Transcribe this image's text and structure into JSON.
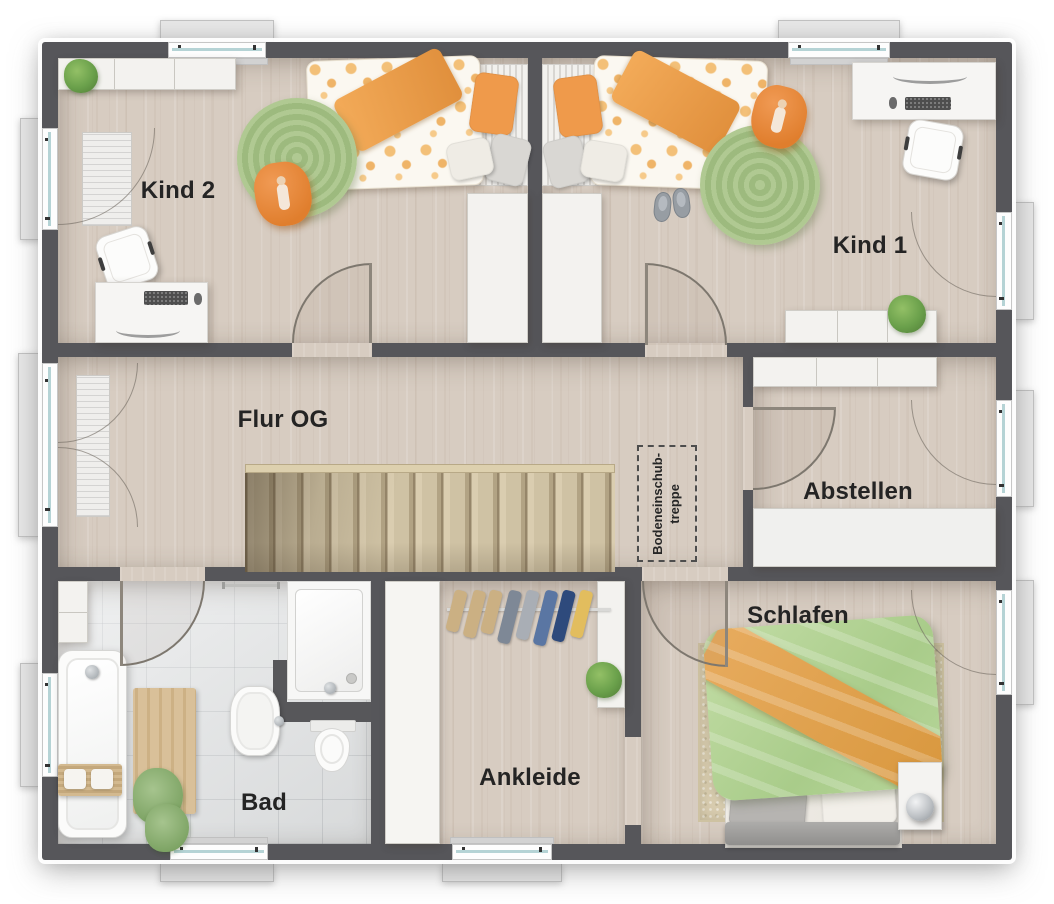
{
  "floorplan": {
    "rooms": [
      {
        "id": "kind2",
        "label": "Kind 2",
        "furniture": [
          "sideboard",
          "plant",
          "single-bed",
          "round-rug",
          "beanbag",
          "desk",
          "desk-chair",
          "wardrobe"
        ]
      },
      {
        "id": "kind1",
        "label": "Kind 1",
        "furniture": [
          "single-bed",
          "slippers",
          "round-rug",
          "beanbag",
          "desk",
          "desk-chair",
          "sideboard",
          "plant",
          "wardrobe"
        ]
      },
      {
        "id": "flur",
        "label": "Flur OG",
        "furniture": [
          "staircase"
        ]
      },
      {
        "id": "abstellen",
        "label": "Abstellen",
        "furniture": [
          "wall-cabinets",
          "shelf"
        ]
      },
      {
        "id": "schlafen",
        "label": "Schlafen",
        "furniture": [
          "double-bed",
          "rug",
          "nightstand",
          "lamp"
        ]
      },
      {
        "id": "ankleide",
        "label": "Ankleide",
        "furniture": [
          "wardrobe",
          "clothes-rail",
          "shelf",
          "plant"
        ]
      },
      {
        "id": "bad",
        "label": "Bad",
        "furniture": [
          "bathtub",
          "bath-mat",
          "towels",
          "sink",
          "toilet",
          "shower",
          "cabinet",
          "towel-bar"
        ]
      }
    ],
    "annotations": [
      {
        "id": "loft-ladder",
        "line1": "Bodeneinschub-",
        "line2": "treppe"
      }
    ],
    "colors": {
      "wall": "#56565a",
      "wood_floor": "#d7ccc1",
      "tile_floor": "#e0e2e3",
      "stair_wood": "#cfc2a4",
      "rug_green": "#a9c489",
      "rug_beige": "#d9cdb0",
      "accent_orange": "#e8873c",
      "duvet_green": "#b9d69c",
      "furniture_white": "#f3f2ef",
      "window_glass": "#b5d3d5"
    }
  }
}
